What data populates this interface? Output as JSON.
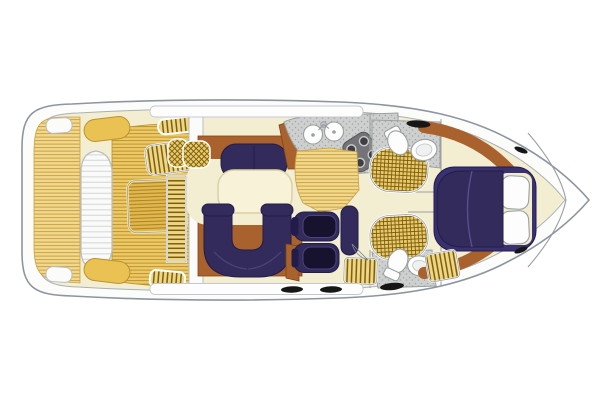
{
  "diagram": {
    "type": "boat-floor-plan",
    "label": "Motor yacht interior floor plan, top view, bow to the right",
    "orientation": "bow-right",
    "areas": [
      {
        "id": "swim-platform",
        "label": "Teak swim platform"
      },
      {
        "id": "stern-bench",
        "label": "Stern bench seat"
      },
      {
        "id": "cockpit",
        "label": "Cockpit with teak deck"
      },
      {
        "id": "cockpit-hatch",
        "label": "Cockpit sunpad / engine hatch"
      },
      {
        "id": "side-deck-steps",
        "label": "Steps to side deck"
      },
      {
        "id": "companionway-steps",
        "label": "Companionway steps"
      },
      {
        "id": "wicker-cabinet",
        "label": "Wicker cabinet"
      },
      {
        "id": "salon",
        "label": "Salon with facing sofa, U-shaped sofa and table"
      },
      {
        "id": "galley",
        "label": "Galley with twin sinks and four-burner stove"
      },
      {
        "id": "head-port",
        "label": "Port head with shower, toilet and basin"
      },
      {
        "id": "head-starboard",
        "label": "Starboard head with shower, toilet and basin"
      },
      {
        "id": "mid-cabin",
        "label": "Mid cabin with two upholstered seats"
      },
      {
        "id": "forward-cabin",
        "label": "Forward cabin with island double bed and pillows"
      },
      {
        "id": "bow-deck",
        "label": "Bow deck"
      }
    ],
    "features": {
      "galley_sinks": 2,
      "stove_burners": 4,
      "bed_pillows": 2,
      "heads": 2,
      "deck_hatches": 4
    }
  },
  "palette": {
    "white": "#ffffff",
    "hull_line": "#8d95a0",
    "inner_line": "#aab0b8",
    "cream": "#f3eed2",
    "teak_light": "#f2d88c",
    "teak": "#ecc964",
    "teak_dark": "#e2b84e",
    "grid_bg": "#eac96b",
    "grid_line": "#7a5e10",
    "counter": "#cdd0ce",
    "stove": "#737378",
    "navy": "#322b5c",
    "navy_bed": "#3a3270",
    "wood": "#a9622d",
    "black": "#161616"
  }
}
